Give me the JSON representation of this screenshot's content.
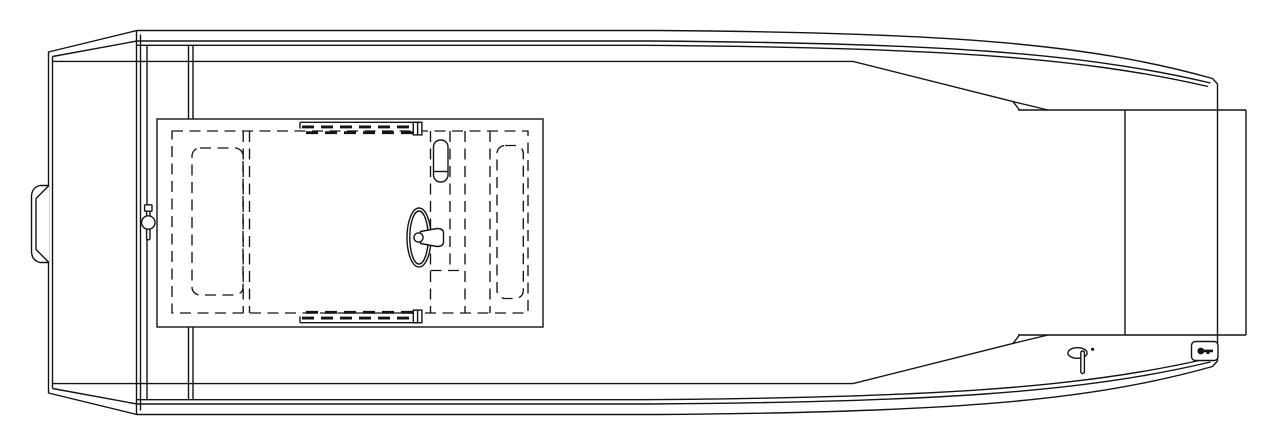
{
  "meta": {
    "canvas_width": 1280,
    "canvas_height": 448,
    "kind": "technical-line-drawing",
    "subject": "Flat-bottom center-console boat, plan (top) view, stern at left, bow at right"
  },
  "colors": {
    "background": "#ffffff",
    "line": "#141414"
  },
  "diagram": {
    "components": [
      {
        "name": "hull-outline",
        "desc": "outer hull silhouette with beveled transom corners and tapered bow"
      },
      {
        "name": "transom",
        "desc": "flat stern wall, double plating lines"
      },
      {
        "name": "motor-mount-bracket",
        "desc": "curved mounting plate on outside of transom",
        "x": 32,
        "y": 185
      },
      {
        "name": "transom-latch",
        "desc": "T-pin latch with ring on stern band",
        "x": 148,
        "y": 222
      },
      {
        "name": "stern-band",
        "desc": "vertical bench / splash-well band behind console",
        "x1": 136,
        "x2": 193
      },
      {
        "name": "gunwale-lines",
        "desc": "inner and rub-rail lines along both sides"
      },
      {
        "name": "center-console",
        "desc": "console deck module",
        "x": 157,
        "y": 119,
        "w": 386,
        "h": 208
      },
      {
        "name": "console-inset",
        "desc": "dashed inner deck outline"
      },
      {
        "name": "port-seat",
        "desc": "dashed seat cushion outline, left of console"
      },
      {
        "name": "starboard-seat",
        "desc": "dashed seat cushion outline, right of console"
      },
      {
        "name": "steering-wheel",
        "desc": "helm wheel drawn edge-on with hub cone",
        "x": 419,
        "y": 237
      },
      {
        "name": "throttle-control",
        "desc": "rounded throttle base pad",
        "x": 434,
        "y": 140
      },
      {
        "name": "helm-partition",
        "desc": "dashed partition lines around helm"
      },
      {
        "name": "grab-rail-top",
        "desc": "toothed rail strip on upper console edge",
        "x": 300,
        "y": 122
      },
      {
        "name": "grab-rail-bottom",
        "desc": "toothed rail strip on lower console edge",
        "x": 300,
        "y": 322
      },
      {
        "name": "bow-platform",
        "desc": "raised bow deck pod overhanging bow face",
        "x": 1018,
        "y": 110,
        "w": 228,
        "h": 225
      },
      {
        "name": "bow-face",
        "desc": "flat vertical bow end",
        "x": 1218
      },
      {
        "name": "bow-light",
        "desc": "navigation light fixture with stem and dot",
        "x": 1077,
        "y": 353
      },
      {
        "name": "keyhole-plate",
        "desc": "small plate with key glyph at bow corner",
        "x": 1192,
        "y": 342
      }
    ]
  }
}
